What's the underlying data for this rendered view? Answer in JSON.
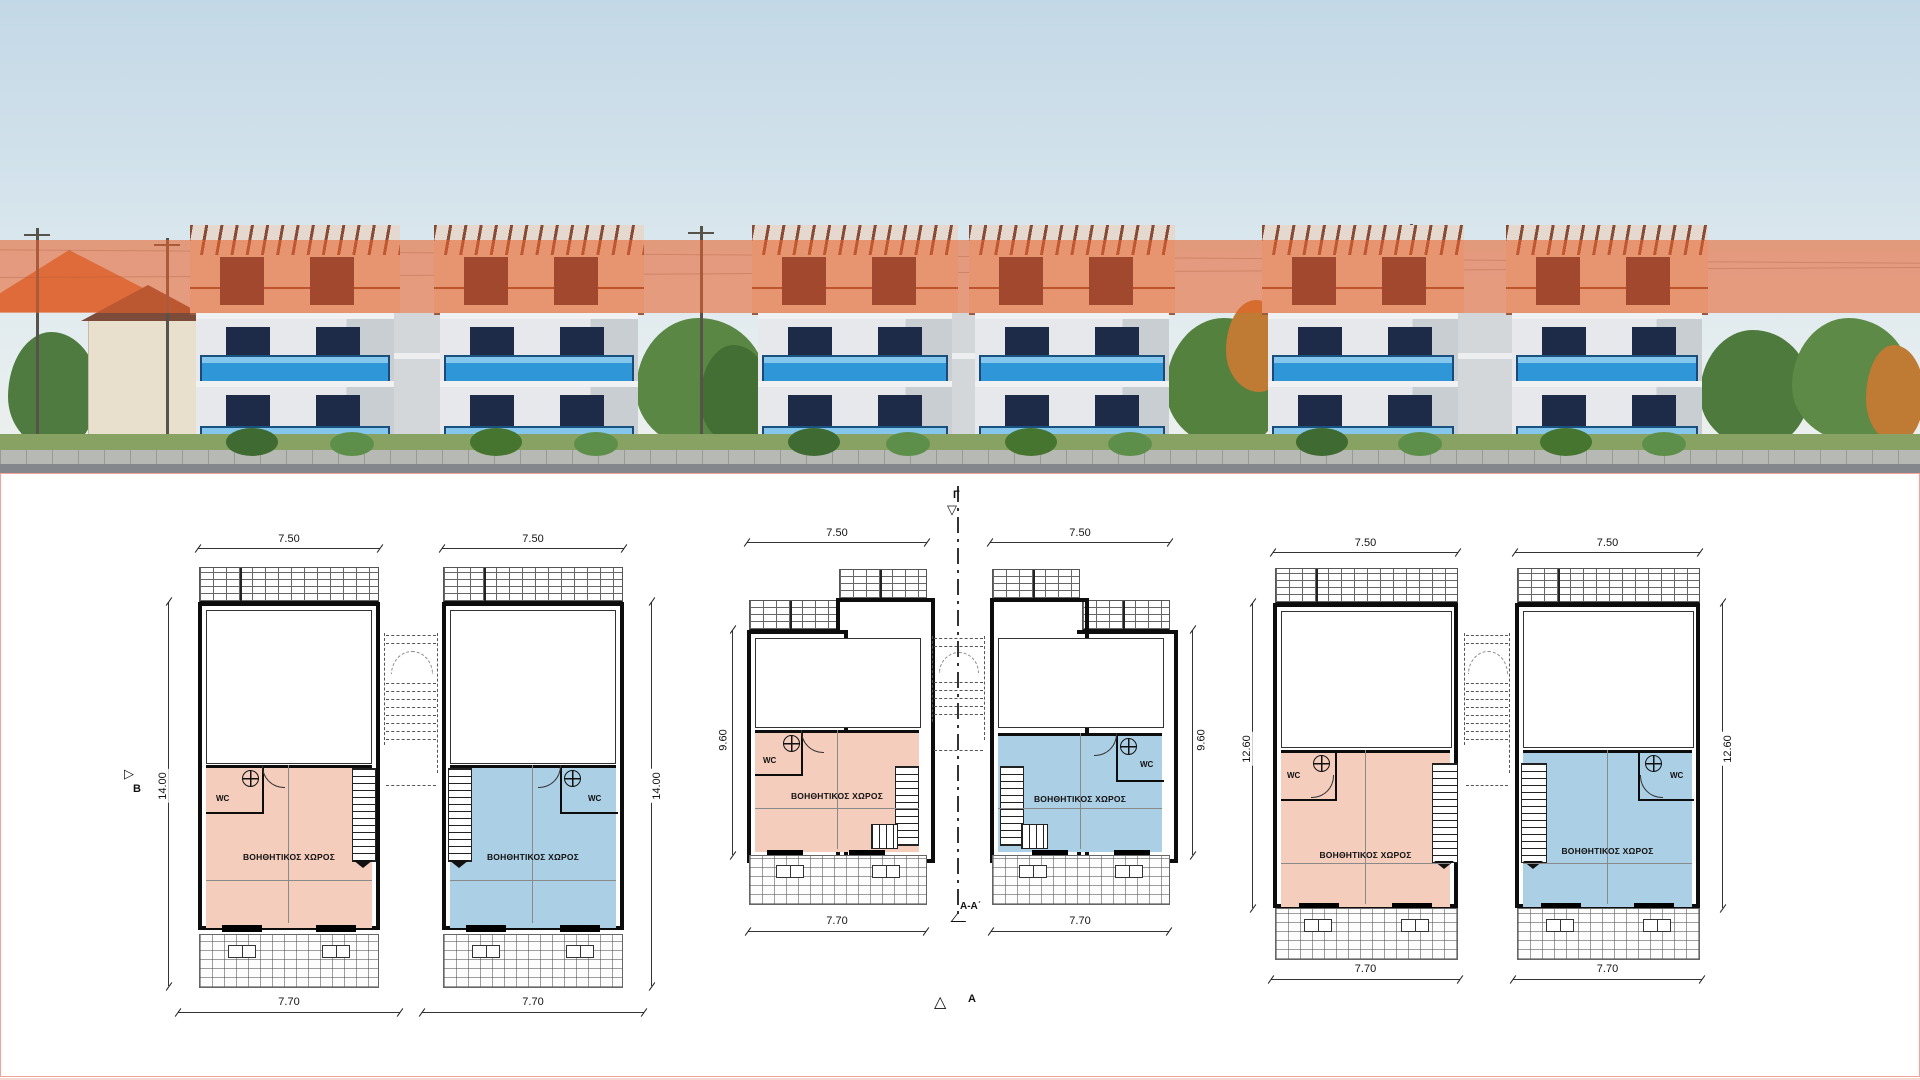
{
  "sheet": {
    "description": "Row-house elevation rendering with highlighted attic level above six ground/auxiliary floor plans"
  },
  "markers": {
    "beta": "Β",
    "gamma": "Γ",
    "section_aa": "Α-Α΄",
    "alpha": "Α",
    "tri_right": "▷",
    "tri_down": "▽",
    "tri_up": "△"
  },
  "plans": [
    {
      "id": "pair1-left",
      "top_dim": "7.50",
      "bottom_dim": "7.70",
      "side_dim": "14.00",
      "room_label": "ΒΟΗΘΗΤΙΚΟΣ ΧΩΡΟΣ",
      "wc_label": "WC"
    },
    {
      "id": "pair1-right",
      "top_dim": "7.50",
      "bottom_dim": "7.70",
      "side_dim": "14.00",
      "room_label": "ΒΟΗΘΗΤΙΚΟΣ ΧΩΡΟΣ",
      "wc_label": "WC"
    },
    {
      "id": "pair2-left",
      "top_dim": "7.50",
      "bottom_dim": "7.70",
      "side_dim": "9.60",
      "room_label": "ΒΟΗΘΗΤΙΚΟΣ ΧΩΡΟΣ",
      "wc_label": "WC"
    },
    {
      "id": "pair2-right",
      "top_dim": "7.50",
      "bottom_dim": "7.70",
      "side_dim": "9.60",
      "room_label": "ΒΟΗΘΗΤΙΚΟΣ ΧΩΡΟΣ",
      "wc_label": "WC"
    },
    {
      "id": "pair3-left",
      "top_dim": "7.50",
      "bottom_dim": "7.70",
      "side_dim": "12.60",
      "room_label": "ΒΟΗΘΗΤΙΚΟΣ ΧΩΡΟΣ",
      "wc_label": "WC"
    },
    {
      "id": "pair3-right",
      "top_dim": "7.50",
      "bottom_dim": "7.70",
      "side_dim": "12.60",
      "room_label": "ΒΟΗΘΗΤΙΚΟΣ ΧΩΡΟΣ",
      "wc_label": "WC"
    }
  ],
  "colors": {
    "highlight_overlay": "#E8622C",
    "room_pink": "#F5CDBD",
    "room_blue": "#ABCFE5",
    "balcony_blue": "#2F97D8",
    "panel_frame": "#F2A39B"
  }
}
